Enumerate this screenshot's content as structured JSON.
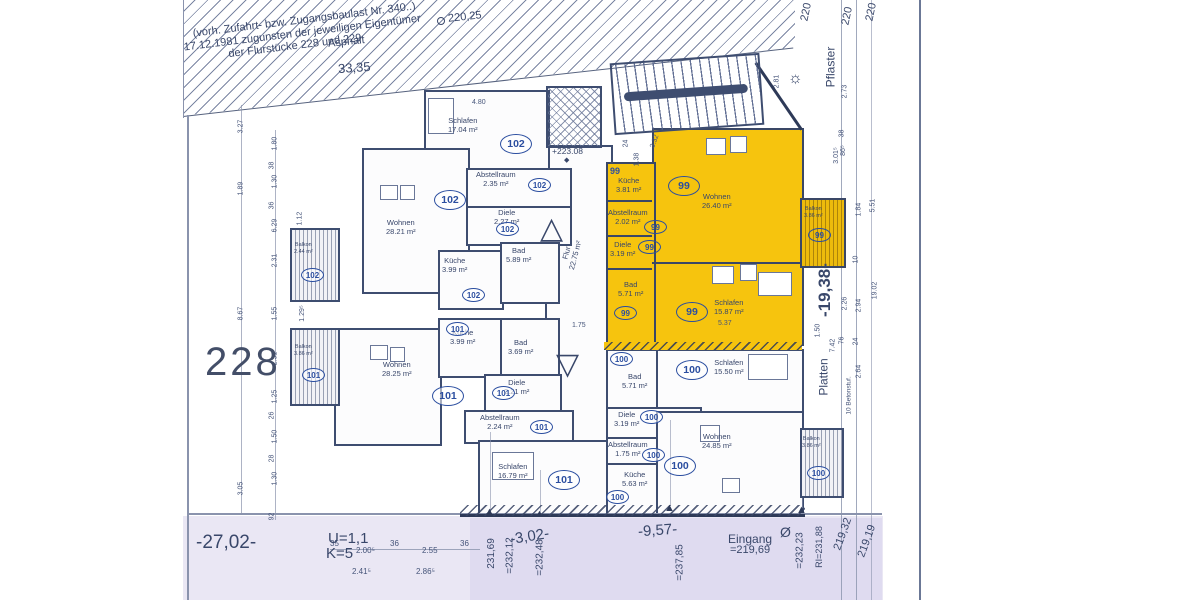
{
  "colors": {
    "highlight_yellow": "#f6c40e",
    "line_blue": "#3e4d70",
    "badge_blue": "#2b4ea0",
    "tint_lavender": "#eae7f4"
  },
  "legal_note": {
    "line1": "(vorh. Zufahrt- bzw. Zugangsbaulast Nr. 340..)",
    "line2": "17.12.1981 zugunsten der jeweiligen Eigentümer",
    "line3": "der Flurstücke 228 und 229"
  },
  "site": {
    "asphalt": "Asphalt",
    "pflaster": "Pflaster",
    "platten": "Platten",
    "eingang": "Eingang",
    "parcel": "228",
    "sun_symbol": "☼",
    "survey_circle": "Ø",
    "marker": "▲",
    "tri_up": "△",
    "tri_down": "▽",
    "diamond": "◆"
  },
  "levels": {
    "top_right_1": "220",
    "top_right_2": "220",
    "top_right_3": "220",
    "pt_220_25": "220,25",
    "pt_223_08": "+223.08",
    "eingang_level": "=219,69",
    "b_231_69": "231,69",
    "b_232_12": "=232,12",
    "b_232_48": "=232,48",
    "b_237_85": "=237,85",
    "b_232_23": "=232,23",
    "b_ri_231_88": "RI=231,88",
    "b_219_32": "219,32",
    "b_219_19": "219,19"
  },
  "main_dims": {
    "d33_35": "33,35",
    "d27_02": "-27,02-",
    "d3_02": "-3,02-",
    "d9_57": "-9,57-",
    "d19_38": "-19,38-",
    "u_value": "U=1,1",
    "k_value": "K=5",
    "d1_75": "1.75",
    "d5_37": "5.37",
    "d4_80": "4.80",
    "d24": "24",
    "d1_38": "1.38",
    "d3_32": "3.32",
    "d2_81": "2.81"
  },
  "corridor": {
    "name": "Flur",
    "area": "22.75 m²"
  },
  "apartments": {
    "a102": {
      "id": "102",
      "rooms": {
        "schlafen": {
          "name": "Schlafen",
          "area": "17.04 m²"
        },
        "abstellraum": {
          "name": "Abstellraum",
          "area": "2.35 m²"
        },
        "diele": {
          "name": "Diele",
          "area": "2.27 m²"
        },
        "wohnen": {
          "name": "Wohnen",
          "area": "28.21 m²"
        },
        "kueche": {
          "name": "Küche",
          "area": "3.99 m²"
        },
        "bad": {
          "name": "Bad",
          "area": "5.89 m²"
        },
        "balkon": {
          "name": "Balkon",
          "area": "2.44 m²"
        }
      }
    },
    "a101": {
      "id": "101",
      "rooms": {
        "wohnen": {
          "name": "Wohnen",
          "area": "28.25 m²"
        },
        "kueche": {
          "name": "Küche",
          "area": "3.99 m²"
        },
        "bad": {
          "name": "Bad",
          "area": "3.69 m²"
        },
        "diele": {
          "name": "Diele",
          "area": "2.21 m²"
        },
        "abstellraum": {
          "name": "Abstellraum",
          "area": "2.24 m²"
        },
        "schlafen": {
          "name": "Schlafen",
          "area": "16.79 m²"
        },
        "balkon": {
          "name": "Balkon",
          "area": "3.86 m²"
        }
      }
    },
    "a99": {
      "id": "99",
      "rooms": {
        "kueche": {
          "name": "Küche",
          "area": "3.81 m²"
        },
        "wohnen": {
          "name": "Wohnen",
          "area": "26.40 m²"
        },
        "abstellraum": {
          "name": "Abstellraum",
          "area": "2.02 m²"
        },
        "diele": {
          "name": "Diele",
          "area": "3.19 m²"
        },
        "bad": {
          "name": "Bad",
          "area": "5.71 m²"
        },
        "schlafen": {
          "name": "Schlafen",
          "area": "15.87 m²"
        },
        "balkon": {
          "name": "Balkon",
          "area": "3.86 m²"
        }
      }
    },
    "a100": {
      "id": "100",
      "rooms": {
        "bad": {
          "name": "Bad",
          "area": "5.71 m²"
        },
        "schlafen": {
          "name": "Schlafen",
          "area": "15.50 m²"
        },
        "diele": {
          "name": "Diele",
          "area": "3.19 m²"
        },
        "abstellraum": {
          "name": "Abstellraum",
          "area": "1.75 m²"
        },
        "kueche": {
          "name": "Küche",
          "area": "5.63 m²"
        },
        "wohnen": {
          "name": "Wohnen",
          "area": "24.85 m²"
        },
        "balkon": {
          "name": "Balkon",
          "area": "3.86 m²"
        }
      }
    }
  },
  "dim_chains": {
    "left_outer": [
      "3.27",
      "1.89",
      "8.67",
      "3.05"
    ],
    "left_inner": [
      "1.80",
      "38",
      "1.30",
      "36",
      "6.29",
      "2.31",
      "1.55",
      "2.31",
      "1.25",
      "26",
      "1.50",
      "28",
      "1.30",
      "92"
    ],
    "left_inner2": [
      "1.12",
      "1.29⁵"
    ],
    "right_a": [
      "2.73",
      "38",
      "86⁵",
      "2.26",
      "76",
      "10 Betonstuf."
    ],
    "right_b": [
      "1.84",
      "10",
      "2.94",
      "24",
      "2.64",
      "7.42"
    ],
    "right_c": [
      "5.51",
      "19.02",
      "3.01⁵",
      "1.50"
    ],
    "bottom_row1": [
      "35",
      "2.00⁵",
      "36",
      "2.55",
      "36"
    ],
    "bottom_row2": [
      "2.41⁵",
      "2.86⁵"
    ]
  }
}
